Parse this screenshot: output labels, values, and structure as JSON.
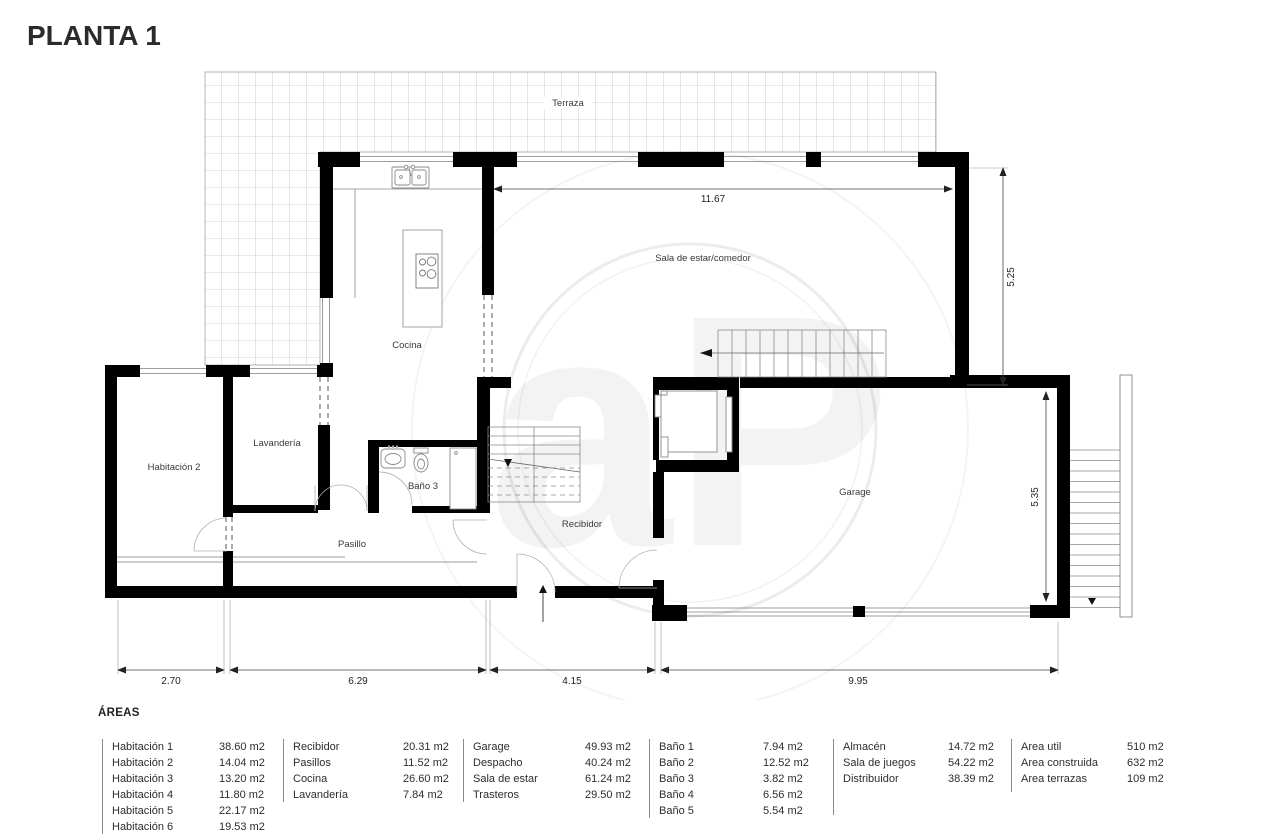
{
  "title": "PLANTA 1",
  "plan": {
    "rooms": {
      "terraza": "Terraza",
      "sala": "Sala de estar/comedor",
      "cocina": "Cocina",
      "habitacion2": "Habitación 2",
      "lavanderia": "Lavandería",
      "bano3": "Baño 3",
      "pasillo": "Pasillo",
      "recibidor": "Recibidor",
      "garage": "Garage"
    },
    "dims": {
      "top": "11.67",
      "right_upper": "5.25",
      "right_lower": "5.35",
      "bottom_1": "2.70",
      "bottom_2": "6.29",
      "bottom_3": "4.15",
      "bottom_4": "9.95"
    }
  },
  "areas": {
    "heading": "ÁREAS",
    "columns": [
      {
        "rows": [
          {
            "name": "Habitación 1",
            "value": "38.60 m2"
          },
          {
            "name": "Habitación 2",
            "value": "14.04 m2"
          },
          {
            "name": "Habitación 3",
            "value": "13.20 m2"
          },
          {
            "name": "Habitación 4",
            "value": "11.80 m2"
          },
          {
            "name": "Habitación 5",
            "value": "22.17 m2"
          },
          {
            "name": "Habitación 6",
            "value": "19.53 m2"
          }
        ]
      },
      {
        "rows": [
          {
            "name": "Recibidor",
            "value": "20.31 m2"
          },
          {
            "name": "Pasillos",
            "value": "11.52 m2"
          },
          {
            "name": "Cocina",
            "value": "26.60 m2"
          },
          {
            "name": "Lavandería",
            "value": "7.84 m2"
          }
        ]
      },
      {
        "rows": [
          {
            "name": "Garage",
            "value": "49.93 m2"
          },
          {
            "name": "Despacho",
            "value": "40.24 m2"
          },
          {
            "name": "Sala de estar",
            "value": "61.24 m2"
          },
          {
            "name": "Trasteros",
            "value": "29.50 m2"
          }
        ]
      },
      {
        "rows": [
          {
            "name": "Baño 1",
            "value": "7.94 m2"
          },
          {
            "name": "Baño 2",
            "value": "12.52 m2"
          },
          {
            "name": "Baño 3",
            "value": "3.82 m2"
          },
          {
            "name": "Baño 4",
            "value": "6.56 m2"
          },
          {
            "name": "Baño 5",
            "value": "5.54 m2"
          }
        ]
      },
      {
        "rows": [
          {
            "name": "Almacén",
            "value": "14.72 m2"
          },
          {
            "name": "Sala de juegos",
            "value": "54.22 m2"
          },
          {
            "name": "Distribuidor",
            "value": "38.39 m2"
          }
        ]
      },
      {
        "rows": [
          {
            "name": "Area util",
            "value": "510 m2"
          },
          {
            "name": "Area construida",
            "value": "632 m2"
          },
          {
            "name": "Area terrazas",
            "value": "109 m2"
          }
        ]
      }
    ]
  }
}
